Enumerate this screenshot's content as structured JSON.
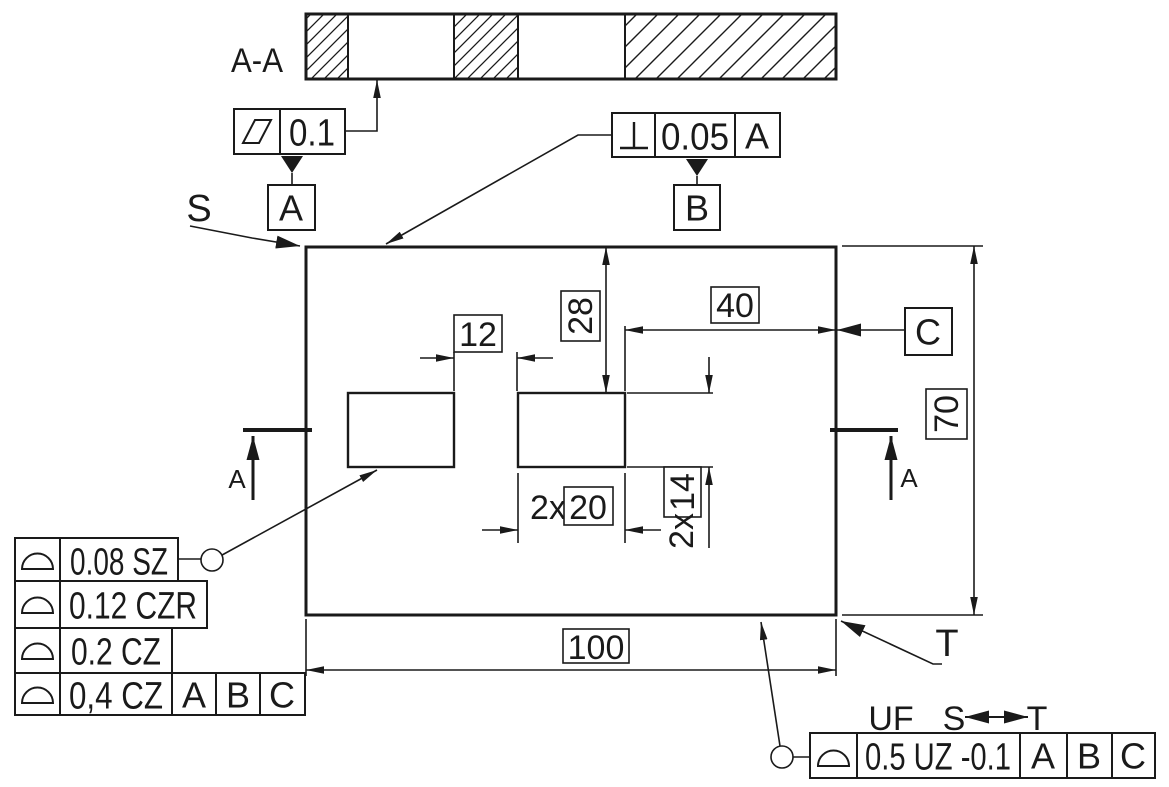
{
  "colors": {
    "ink": "#1a1a1a",
    "paper": "#ffffff"
  },
  "section_view": {
    "label": "A-A"
  },
  "flatness_frame": {
    "symbol": "flatness",
    "tolerance": "0.1",
    "datum": "A"
  },
  "perpendicularity_frame": {
    "symbol": "perpendicularity",
    "tolerance": "0.05",
    "datum_ref": "A",
    "datum": "B"
  },
  "view_labels": {
    "start": "S",
    "end": "T"
  },
  "datum_c": {
    "label": "C"
  },
  "section_arrows": {
    "left": "A",
    "right": "A"
  },
  "dims": {
    "slot_gap": "12",
    "top_offset": "28",
    "right_offset": "40",
    "height": "70",
    "slot_width_qty": "2x",
    "slot_width": "20",
    "slot_height_qty": "2x",
    "slot_height": "14",
    "width": "100"
  },
  "profile_stack": {
    "rows": [
      {
        "symbol": "profile-of-surface",
        "tolerance": "0.08 SZ"
      },
      {
        "symbol": "profile-of-surface",
        "tolerance": "0.12 CZR"
      },
      {
        "symbol": "profile-of-surface",
        "tolerance": "0.2 CZ"
      },
      {
        "symbol": "profile-of-surface",
        "tolerance": "0,4 CZ",
        "datum1": "A",
        "datum2": "B",
        "datum3": "C"
      }
    ]
  },
  "uf_frame": {
    "prefix": "UF",
    "from": "S",
    "to": "T",
    "symbol": "profile-of-surface",
    "tolerance": "0.5 UZ -0.1",
    "datum1": "A",
    "datum2": "B",
    "datum3": "C"
  }
}
